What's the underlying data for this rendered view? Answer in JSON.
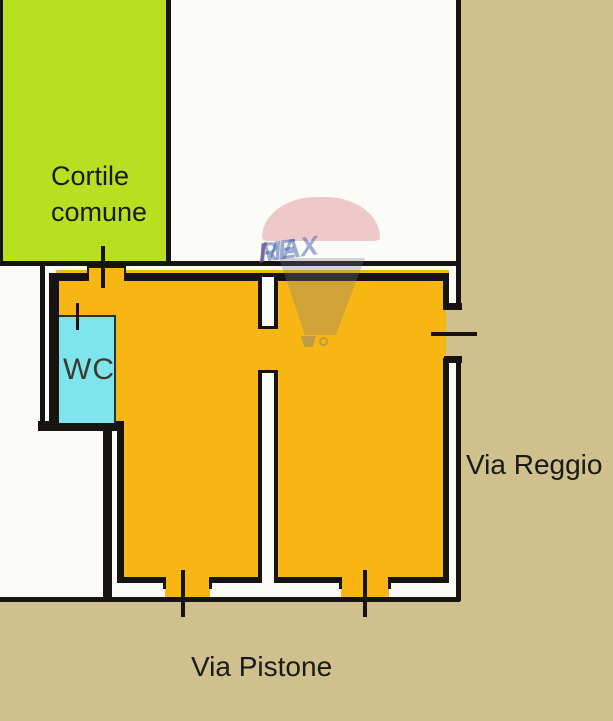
{
  "plan": {
    "labels": {
      "courtyard": "Cortile comune",
      "wc": "WC",
      "street_right": "Via Reggio",
      "street_bottom": "Via Pistone"
    },
    "watermark": {
      "brand_re": "RE",
      "brand_slash": "/",
      "brand_max": "MAX"
    },
    "colors": {
      "street_tan": "#cfc08d",
      "courtyard_green": "#b8e020",
      "unit_orange": "#f7b614",
      "wc_cyan": "#7fe5ec",
      "wall_black": "#171310",
      "paper_white": "#fbfbf8",
      "label_black": "#1a1a14",
      "remax_blue": "rgba(62,95,170,0.50)",
      "remax_red": "rgba(205,55,70,0.55)",
      "balloon_pink": "rgba(213,85,95,0.30)",
      "balloon_grey": "rgba(115,120,133,0.30)"
    }
  }
}
